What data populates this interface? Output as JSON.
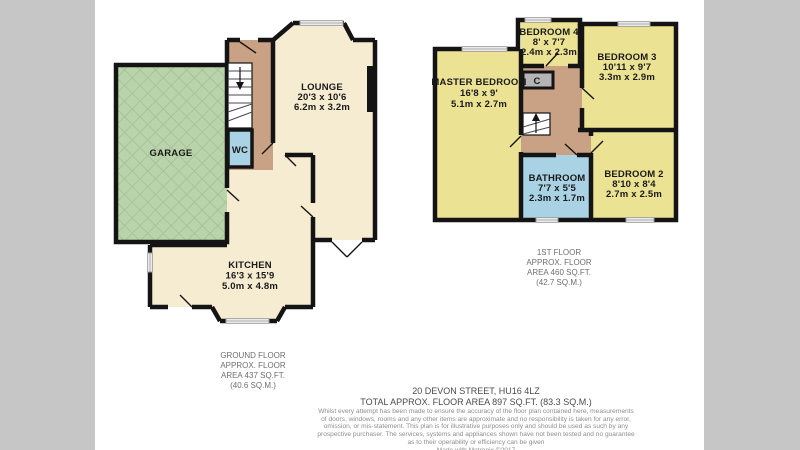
{
  "colors": {
    "walls": "#141414",
    "room_cream": "#f6ecd2",
    "garage_green": "#b9d3ab",
    "garage_hatch": "#a6c498",
    "hall_tan": "#c9a184",
    "wet_room_blue": "#a9d2e4",
    "bedroom_yellow": "#ece293",
    "cupboard_grey": "#b5b5b5",
    "side_grey": "#c6c6c6"
  },
  "ground_floor": {
    "caption": [
      "GROUND FLOOR",
      "APPROX. FLOOR",
      "AREA 437 SQ.FT.",
      "(40.6 SQ.M.)"
    ],
    "rooms": {
      "garage": {
        "name": "GARAGE"
      },
      "wc": {
        "name": "WC"
      },
      "lounge": {
        "name": "LOUNGE",
        "dims_imperial": "20'3 x 10'6",
        "dims_metric": "6.2m x 3.2m"
      },
      "kitchen": {
        "name": "KITCHEN",
        "dims_imperial": "16'3 x 15'9",
        "dims_metric": "5.0m x 4.8m"
      }
    }
  },
  "first_floor": {
    "caption": [
      "1ST FLOOR",
      "APPROX. FLOOR",
      "AREA 460 SQ.FT.",
      "(42.7 SQ.M.)"
    ],
    "rooms": {
      "master_bedroom": {
        "name": "MASTER BEDROOM",
        "dims_imperial": "16'8 x 9'",
        "dims_metric": "5.1m x 2.7m"
      },
      "bedroom_4": {
        "name": "BEDROOM 4",
        "dims_imperial": "8' x 7'7",
        "dims_metric": "2.4m x 2.3m"
      },
      "bedroom_3": {
        "name": "BEDROOM 3",
        "dims_imperial": "10'11 x 9'7",
        "dims_metric": "3.3m x 2.9m"
      },
      "bedroom_2": {
        "name": "BEDROOM 2",
        "dims_imperial": "8'10 x 8'4",
        "dims_metric": "2.7m x 2.5m"
      },
      "bathroom": {
        "name": "BATHROOM",
        "dims_imperial": "7'7 x 5'5",
        "dims_metric": "2.3m x 1.7m"
      },
      "cupboard": {
        "name": "C"
      }
    }
  },
  "footer": {
    "address": "20 DEVON STREET, HU16 4LZ",
    "total_area": "TOTAL APPROX. FLOOR AREA 897 SQ.FT. (83.3 SQ.M.)",
    "disclaimer": [
      "Whilst every attempt has been made to ensure the accuracy of the floor plan contained here, measurements",
      "of doors, windows, rooms and any other items are approximate and no responsibility is taken for any error,",
      "omission, or mis-statement. This plan is for illustrative purposes only and should be used as such by any",
      "prospective purchaser. The services, systems and appliances shown have not been tested and no guarantee",
      "as to their operability or efficiency can be given"
    ],
    "credit": "Made with Metropix ©2017"
  }
}
